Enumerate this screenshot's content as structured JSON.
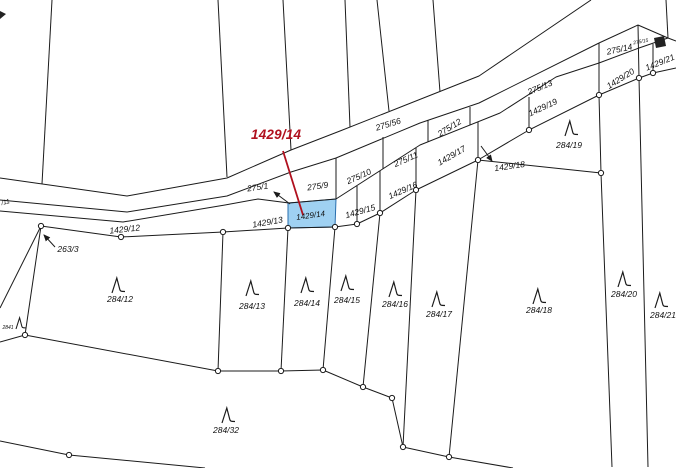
{
  "callout": {
    "label": "1429/14",
    "color": "#b0101e"
  },
  "map": {
    "width": 676,
    "height": 468,
    "line_color": "#1b1b1b",
    "highlight_parcel": {
      "label": "1429/14",
      "fill": "#9fd1f2",
      "stroke": "#2a6fae",
      "points": "288,203 336,199 335,227 288,228"
    },
    "red_line": {
      "x1": 283,
      "y1": 151,
      "x2": 303,
      "y2": 215,
      "color": "#b0101e"
    },
    "polylines": [
      {
        "name": "band-top",
        "pts": "0,178 127,196 227,178 291,150 340,131 479,76 591,0"
      },
      {
        "name": "band-bottom",
        "pts": "0,200 127,212 227,196 291,172 336,158 420,123 479,103 599,43"
      },
      {
        "name": "strip-top",
        "pts": "0,211 123,222 225,205 258,199 289,203 336,199 420,145 500,113 556,77 599,63 639,48 668,38"
      },
      {
        "name": "strip-bottom",
        "pts": "41,226 121,237 223,232 288,228 335,227 357,224 380,213 416,190 478,160 529,130 599,95 639,78 653,73 676,68"
      },
      {
        "name": "top-line-1",
        "pts": "52,0 42,184"
      },
      {
        "name": "top-line-2",
        "pts": "218,0 227,177"
      },
      {
        "name": "top-line-3",
        "pts": "283,0 291,150"
      },
      {
        "name": "top-line-4",
        "pts": "345,0 350,127"
      },
      {
        "name": "top-line-5",
        "pts": "377,0 389,111"
      },
      {
        "name": "top-line-6",
        "pts": "433,0 440,92"
      },
      {
        "name": "sep-275-9-10",
        "pts": "336,158 336,199"
      },
      {
        "name": "sep-275-10-11",
        "pts": "383,137 383,169"
      },
      {
        "name": "sep-275-11-12",
        "pts": "428,120 428,142"
      },
      {
        "name": "sep-275-12-13",
        "pts": "470,107 470,125"
      },
      {
        "name": "sep-1429-15-16",
        "pts": "357,186 357,224"
      },
      {
        "name": "sep-1429-16-17",
        "pts": "380,171 380,213"
      },
      {
        "name": "sep-1429-17-18",
        "pts": "416,148 416,190"
      },
      {
        "name": "sep-1429-18-19",
        "pts": "478,122 478,160"
      },
      {
        "name": "sep-1429-19b",
        "pts": "529,97 529,130"
      },
      {
        "name": "sep-1429-21",
        "pts": "653,44 653,73"
      },
      {
        "name": "line-599",
        "pts": "599,43 599,95 601,173 612,467"
      },
      {
        "name": "line-639",
        "pts": "638,25 639,78 648,467"
      },
      {
        "name": "parcel275-14-top",
        "pts": "599,43 638,25"
      },
      {
        "name": "parcel275-14-ne",
        "pts": "638,25 668,38"
      },
      {
        "name": "top-right-vert",
        "pts": "666,0 668,38"
      },
      {
        "name": "top-right-ext",
        "pts": "668,38 676,41"
      },
      {
        "name": "bnd-284-12-13",
        "pts": "223,232 218,371"
      },
      {
        "name": "bnd-284-13-14",
        "pts": "288,228 281,371"
      },
      {
        "name": "bnd-284-14-15",
        "pts": "335,227 323,370"
      },
      {
        "name": "bnd-284-15-16",
        "pts": "380,213 363,387"
      },
      {
        "name": "bnd-284-16-17",
        "pts": "416,190 403,447"
      },
      {
        "name": "bnd-284-17-18",
        "pts": "478,160 449,457"
      },
      {
        "name": "bnd-284-19",
        "pts": "478,160 601,173"
      },
      {
        "name": "bottom-boundary",
        "pts": "0,342 25,335 218,371 281,371 323,370 363,387 392,398 403,447 449,457 513,468"
      },
      {
        "name": "bnd-263-a",
        "pts": "41,226 25,335"
      },
      {
        "name": "bnd-263-b",
        "pts": "41,226 0,308"
      },
      {
        "name": "sw-boundary",
        "pts": "0,441 69,455 205,468"
      }
    ],
    "vertices": [
      [
        41,
        226
      ],
      [
        121,
        237
      ],
      [
        223,
        232
      ],
      [
        288,
        228
      ],
      [
        335,
        227
      ],
      [
        357,
        224
      ],
      [
        380,
        213
      ],
      [
        416,
        190
      ],
      [
        478,
        160
      ],
      [
        529,
        130
      ],
      [
        599,
        95
      ],
      [
        639,
        78
      ],
      [
        653,
        73
      ],
      [
        601,
        173
      ],
      [
        25,
        335
      ],
      [
        218,
        371
      ],
      [
        281,
        371
      ],
      [
        323,
        370
      ],
      [
        363,
        387
      ],
      [
        392,
        398
      ],
      [
        403,
        447
      ],
      [
        449,
        457
      ],
      [
        69,
        455
      ]
    ],
    "labels": [
      {
        "t": "275/56",
        "x": 389,
        "y": 127,
        "r": -17,
        "s": 8.5
      },
      {
        "t": "275/1",
        "x": 258,
        "y": 190,
        "r": -8,
        "s": 8.5
      },
      {
        "t": "275/9",
        "x": 318,
        "y": 189,
        "r": -8,
        "s": 8.5
      },
      {
        "t": "275/10",
        "x": 360,
        "y": 179,
        "r": -24,
        "s": 8.5
      },
      {
        "t": "275/11",
        "x": 407,
        "y": 162,
        "r": -24,
        "s": 8.5
      },
      {
        "t": "275/12",
        "x": 451,
        "y": 130,
        "r": -32,
        "s": 8.5
      },
      {
        "t": "275/13",
        "x": 541,
        "y": 90,
        "r": -22,
        "s": 8.5
      },
      {
        "t": "275/14",
        "x": 620,
        "y": 52,
        "r": -12,
        "s": 8.5
      },
      {
        "t": "275/15",
        "x": 641,
        "y": 43,
        "r": -10,
        "s": 5
      },
      {
        "t": "1429/12",
        "x": 125,
        "y": 232,
        "r": -6,
        "s": 8.5
      },
      {
        "t": "1429/13",
        "x": 268,
        "y": 225,
        "r": -10,
        "s": 8.5
      },
      {
        "t": "1429/14",
        "x": 311,
        "y": 218,
        "r": -8,
        "s": 8
      },
      {
        "t": "1429/15",
        "x": 361,
        "y": 214,
        "r": -16,
        "s": 8.5
      },
      {
        "t": "1429/16",
        "x": 404,
        "y": 193,
        "r": -24,
        "s": 8.5
      },
      {
        "t": "1429/17",
        "x": 453,
        "y": 158,
        "r": -30,
        "s": 8.5
      },
      {
        "t": "1429/18",
        "x": 510,
        "y": 169,
        "r": -8,
        "s": 8.5
      },
      {
        "t": "1429/19",
        "x": 544,
        "y": 110,
        "r": -25,
        "s": 8.5
      },
      {
        "t": "1429/20",
        "x": 622,
        "y": 81,
        "r": -32,
        "s": 8.5
      },
      {
        "t": "1429/21",
        "x": 661,
        "y": 65,
        "r": -22,
        "s": 8.5
      },
      {
        "t": "/11",
        "x": 6,
        "y": 204,
        "r": -15,
        "s": 6.5
      },
      {
        "t": "263/3",
        "x": 68,
        "y": 252,
        "r": 0,
        "s": 8.5
      },
      {
        "t": "2841",
        "x": 8,
        "y": 329,
        "r": 0,
        "s": 5
      },
      {
        "t": "284/12",
        "x": 120,
        "y": 302,
        "r": 0,
        "s": 8.5
      },
      {
        "t": "284/13",
        "x": 252,
        "y": 309,
        "r": 0,
        "s": 8.5
      },
      {
        "t": "284/14",
        "x": 307,
        "y": 306,
        "r": 0,
        "s": 8.5
      },
      {
        "t": "284/15",
        "x": 347,
        "y": 303,
        "r": 0,
        "s": 8.5
      },
      {
        "t": "284/16",
        "x": 395,
        "y": 307,
        "r": 0,
        "s": 8.5
      },
      {
        "t": "284/17",
        "x": 439,
        "y": 317,
        "r": 0,
        "s": 8.5
      },
      {
        "t": "284/18",
        "x": 539,
        "y": 313,
        "r": 0,
        "s": 8.5
      },
      {
        "t": "284/19",
        "x": 569,
        "y": 148,
        "r": 0,
        "s": 8.5
      },
      {
        "t": "284/20",
        "x": 624,
        "y": 297,
        "r": 0,
        "s": 8.5
      },
      {
        "t": "284/21",
        "x": 663,
        "y": 318,
        "r": 0,
        "s": 8.5
      },
      {
        "t": "284/32",
        "x": 226,
        "y": 433,
        "r": 0,
        "s": 8.5
      }
    ],
    "trees": [
      [
        112,
        277
      ],
      [
        246,
        280
      ],
      [
        301,
        277
      ],
      [
        341,
        275
      ],
      [
        389,
        281
      ],
      [
        432,
        291
      ],
      [
        533,
        288
      ],
      [
        565,
        120
      ],
      [
        618,
        271
      ],
      [
        655,
        292
      ],
      [
        222,
        407
      ]
    ],
    "small_tree": [
      16,
      317
    ],
    "arrows": [
      {
        "name": "arrow-275-1",
        "x1": 290,
        "y1": 204,
        "x2": 274,
        "y2": 192
      },
      {
        "name": "arrow-1429-18",
        "x1": 481,
        "y1": 146,
        "x2": 492,
        "y2": 161
      },
      {
        "name": "arrow-263-3",
        "x1": 55,
        "y1": 247,
        "x2": 44,
        "y2": 235
      }
    ],
    "solids": [
      {
        "name": "edge-mark-topleft",
        "points": "0,11 6,14 0,19"
      },
      {
        "name": "building-symbol",
        "points": "654,38 664,36 666,46 656,48"
      }
    ]
  }
}
